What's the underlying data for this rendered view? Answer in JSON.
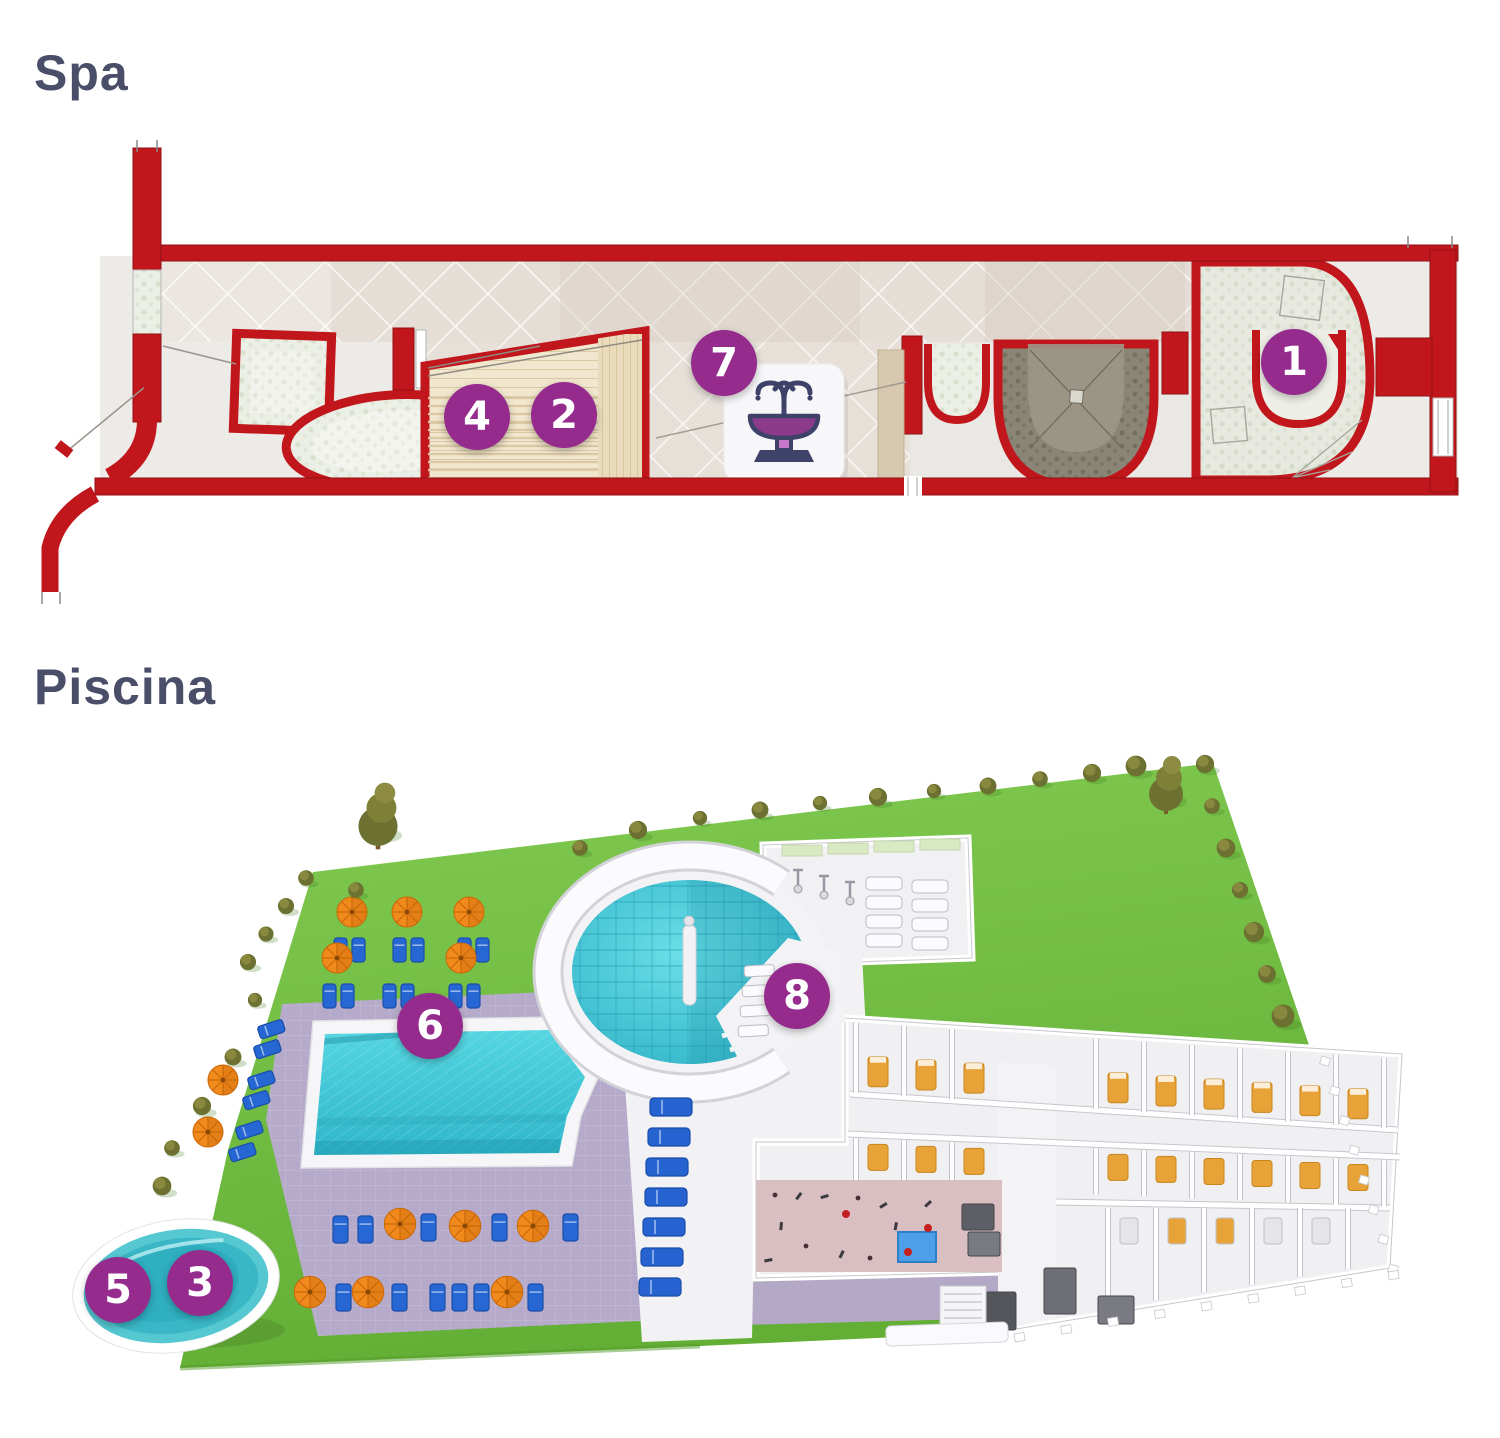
{
  "sections": {
    "spa": {
      "title": "Spa",
      "markers": [
        {
          "label": "1",
          "x": 1294,
          "y": 362
        },
        {
          "label": "2",
          "x": 564,
          "y": 415
        },
        {
          "label": "4",
          "x": 477,
          "y": 417
        },
        {
          "label": "7",
          "x": 724,
          "y": 363
        }
      ]
    },
    "piscina": {
      "title": "Piscina",
      "markers": [
        {
          "label": "3",
          "x": 200,
          "y": 1283
        },
        {
          "label": "5",
          "x": 118,
          "y": 1290
        },
        {
          "label": "6",
          "x": 430,
          "y": 1026
        },
        {
          "label": "8",
          "x": 797,
          "y": 996
        }
      ]
    }
  },
  "icons": {
    "fountain": "fountain-icon"
  },
  "colors": {
    "marker_purple": "#962B8E",
    "wall_red": "#C0161C",
    "title_text": "#4A4E69",
    "water_turquoise": "#3EC9D6",
    "grass_green": "#74BC41",
    "deck_lavender": "#B6AACA",
    "umbrella_orange": "#F08A1C",
    "lounger_blue": "#2663D1",
    "sauna_wood": "#F1E6CE",
    "fountain_navy": "#3E4268",
    "fountain_purple": "#8C3A8C"
  }
}
